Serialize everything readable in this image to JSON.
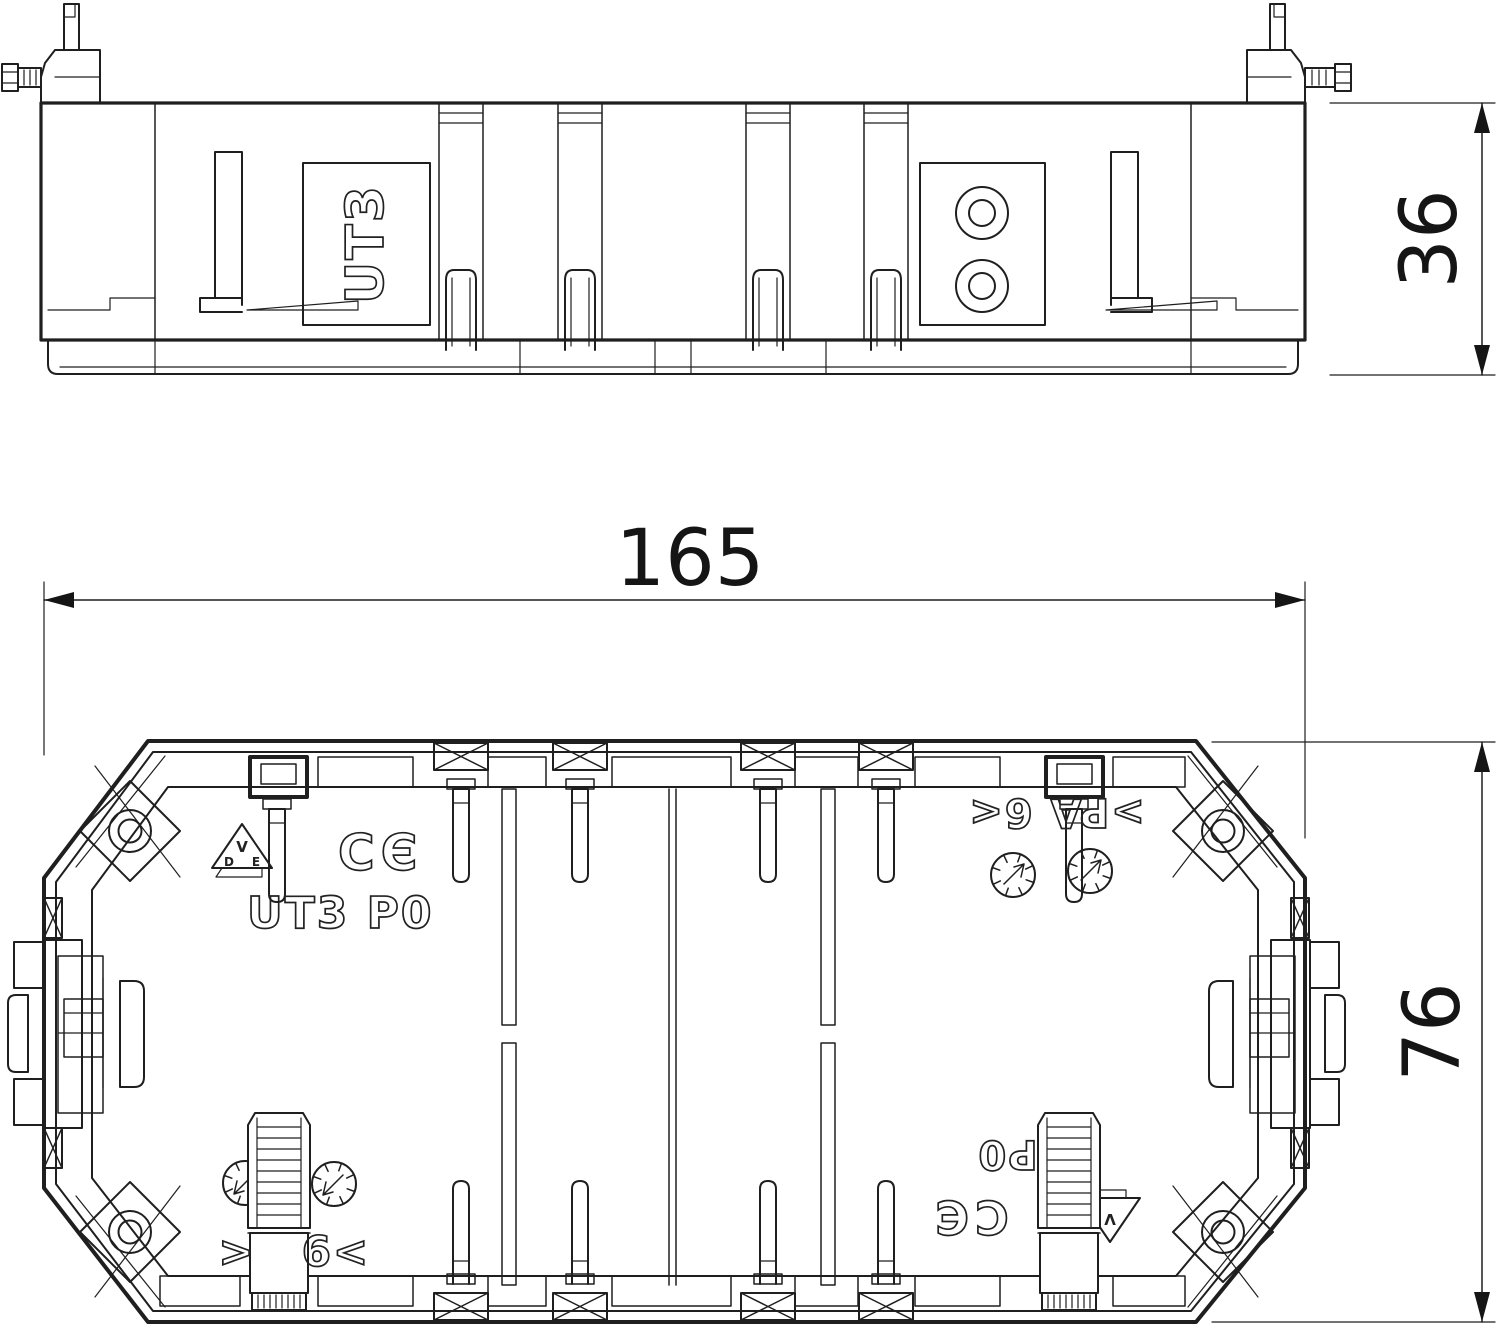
{
  "side_view": {
    "product_label": "UT3"
  },
  "plan_view": {
    "product_label": "UT3 P0",
    "material_marking": ">PA 6<",
    "material_marking_left": ">",
    "material_marking_right": "6<",
    "product_code": "P0",
    "ce_mark": "CE",
    "vde_mark": "VDE",
    "ce_letters": {
      "c": "C",
      "e": "Є"
    },
    "vde_letters": {
      "v": "V",
      "d": "D",
      "e": "E"
    }
  },
  "dimensions": {
    "width": "165",
    "height": "76",
    "depth": "36"
  }
}
